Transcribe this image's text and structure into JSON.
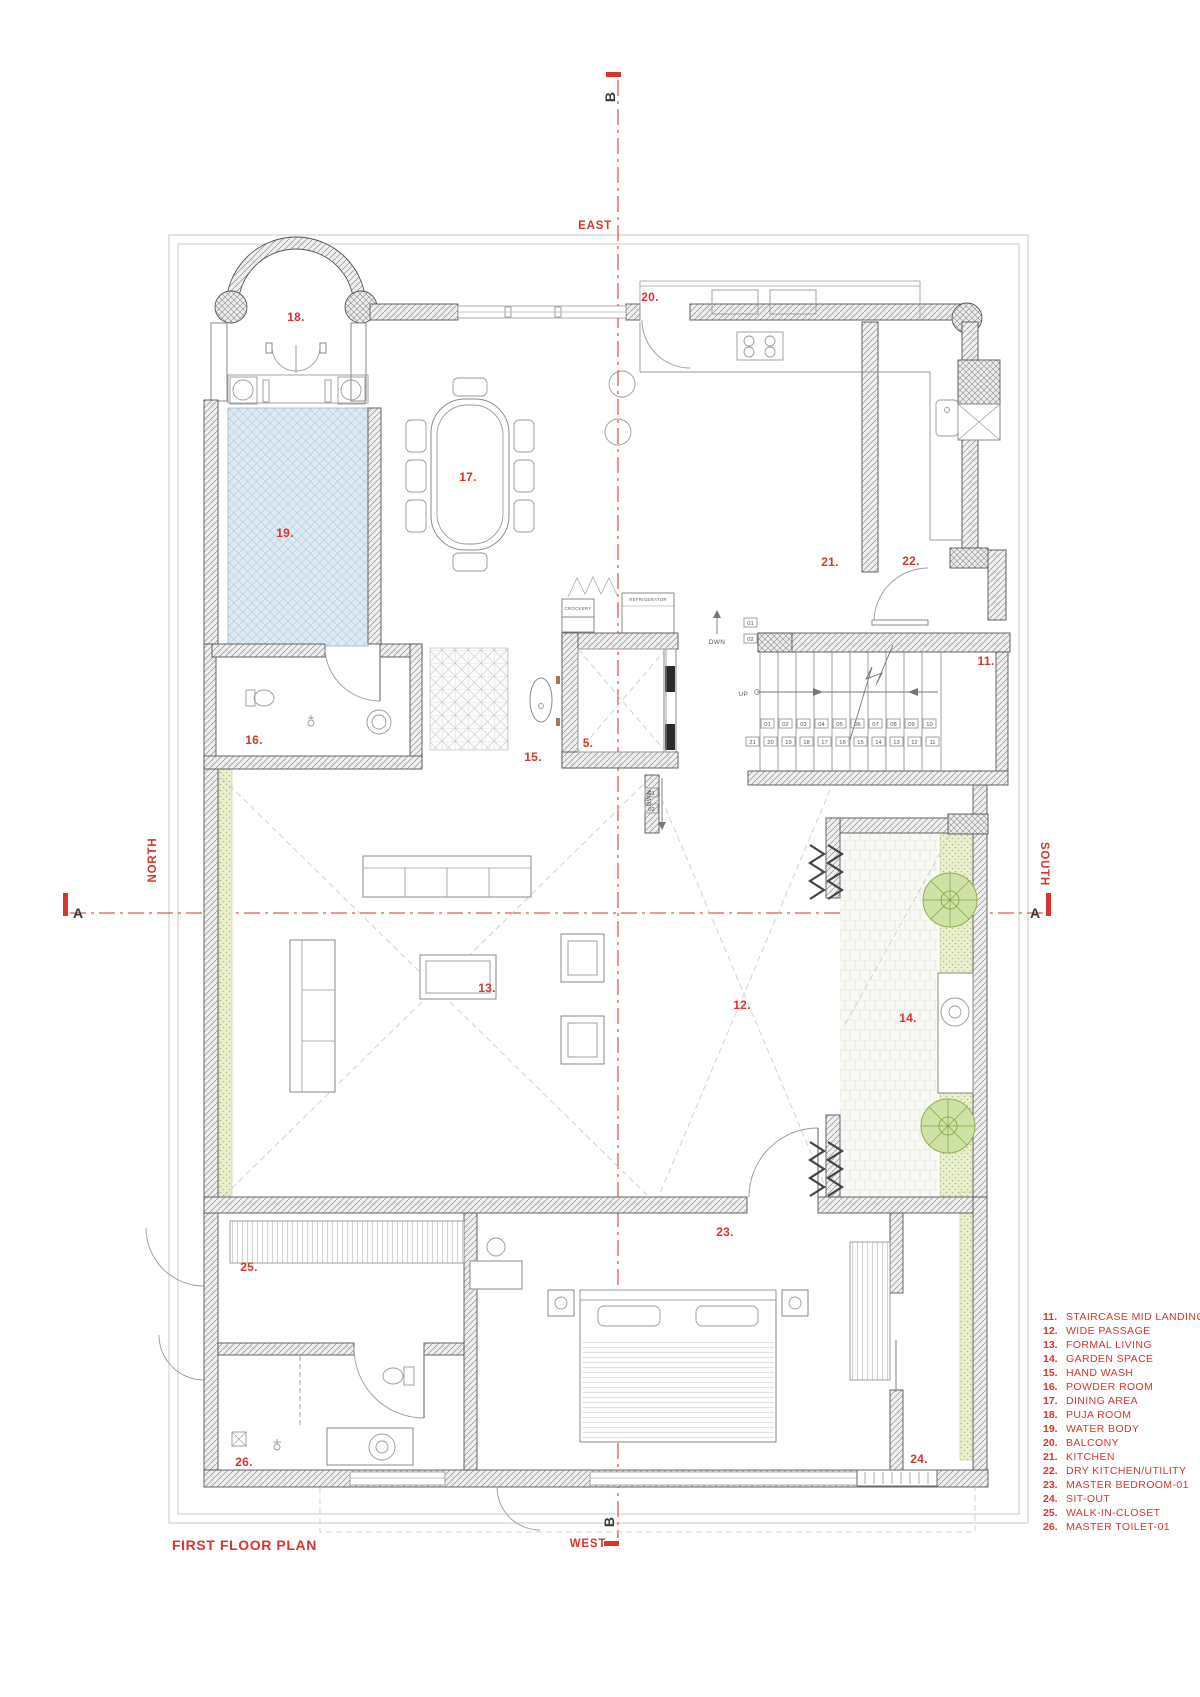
{
  "title": "FIRST FLOOR PLAN",
  "compass": {
    "east": "EAST",
    "west": "WEST",
    "north": "NORTH",
    "south": "SOUTH"
  },
  "sections": {
    "a": "A",
    "b": "B"
  },
  "rooms": {
    "n5": "5.",
    "n11": "11.",
    "n12": "12.",
    "n13": "13.",
    "n14": "14.",
    "n15": "15.",
    "n16": "16.",
    "n17": "17.",
    "n18": "18.",
    "n19": "19.",
    "n20": "20.",
    "n21": "21.",
    "n22": "22.",
    "n23": "23.",
    "n24": "24.",
    "n25": "25.",
    "n26": "26."
  },
  "stairs": {
    "up": "UP",
    "dwn": "DWN",
    "dwn2": "DWN",
    "row1": [
      "01",
      "02",
      "03",
      "04",
      "05",
      "06",
      "07",
      "08",
      "09",
      "10"
    ],
    "row2": [
      "21",
      "20",
      "19",
      "18",
      "17",
      "16",
      "15",
      "14",
      "13",
      "12",
      "11"
    ],
    "side_boxes": [
      "01",
      "02"
    ],
    "lower_boxes": [
      "01",
      "02"
    ]
  },
  "appliances": {
    "crockery": "CROCKERY",
    "refrigerator": "REFRIGERATOR"
  },
  "legend": [
    {
      "num": "11.",
      "name": "STAIRCASE MID LANDING"
    },
    {
      "num": "12.",
      "name": "WIDE PASSAGE"
    },
    {
      "num": "13.",
      "name": "FORMAL LIVING"
    },
    {
      "num": "14.",
      "name": "GARDEN SPACE"
    },
    {
      "num": "15.",
      "name": "HAND WASH"
    },
    {
      "num": "16.",
      "name": "POWDER ROOM"
    },
    {
      "num": "17.",
      "name": "DINING AREA"
    },
    {
      "num": "18.",
      "name": "PUJA ROOM"
    },
    {
      "num": "19.",
      "name": "WATER BODY"
    },
    {
      "num": "20.",
      "name": "BALCONY"
    },
    {
      "num": "21.",
      "name": "KITCHEN"
    },
    {
      "num": "22.",
      "name": "DRY KITCHEN/UTILITY"
    },
    {
      "num": "23.",
      "name": "MASTER BEDROOM-01"
    },
    {
      "num": "24.",
      "name": "SIT-OUT"
    },
    {
      "num": "25.",
      "name": "WALK-IN-CLOSET"
    },
    {
      "num": "26.",
      "name": "MASTER TOILET-01"
    }
  ],
  "colors": {
    "red": "#d8352c",
    "water": "#ddeaf4",
    "green": "#e9efcf",
    "tree": "#cfe2a5"
  }
}
